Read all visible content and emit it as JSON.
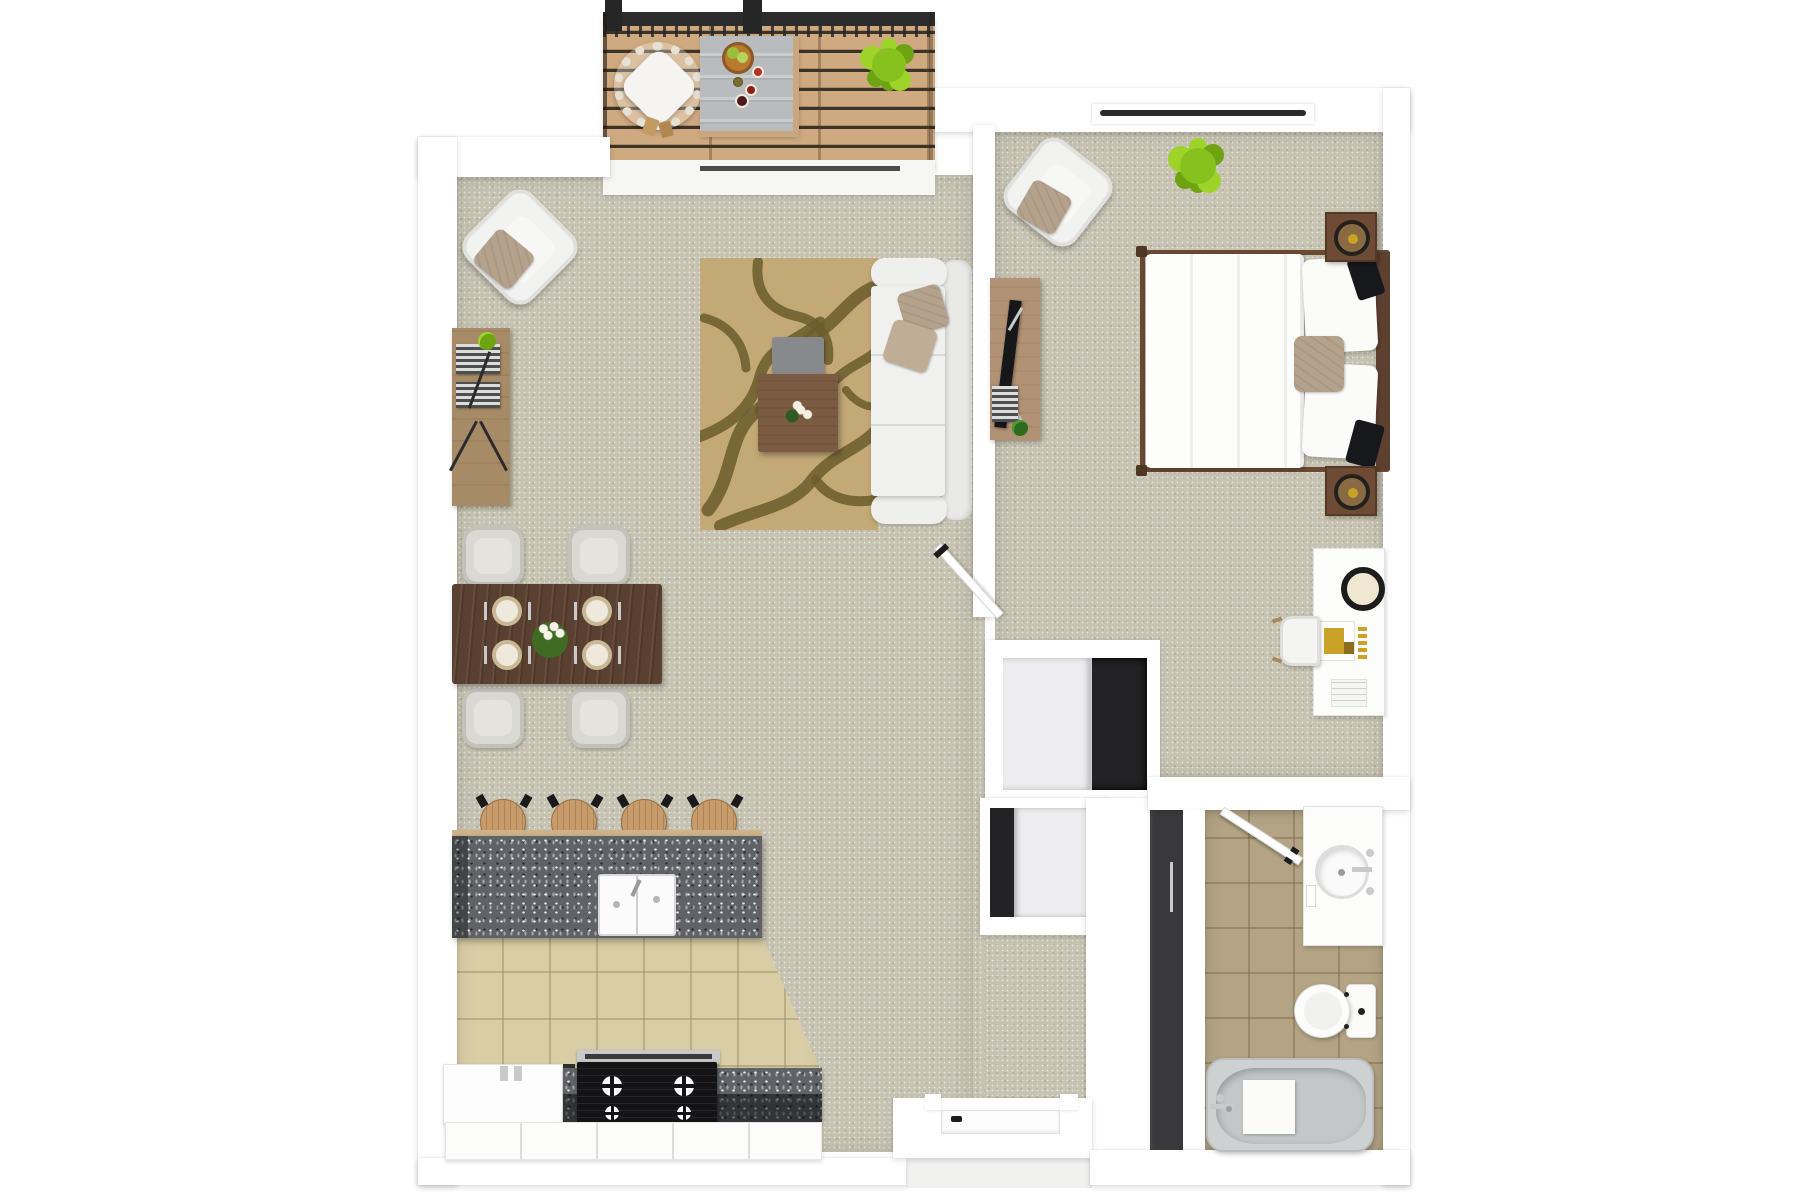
{
  "title": "one-bedroom-apartment-3d-floor-plan",
  "colors": {
    "wall": "#ffffff",
    "carpet": "#c7c3b2",
    "carpetDot": "#a8a593",
    "kitchenTile": "#d9cda6",
    "kitchenTileLine": "rgba(150,135,95,0.45)",
    "bathTile": "#b4a485",
    "bathTileLine": "rgba(120,103,72,0.45)",
    "granite": "#5f6267",
    "woodLight": "#a78b67",
    "walnut": "#5a4030",
    "deckWood": "#cfa97f",
    "deckGap": "#3a332a",
    "deckRail": "#2c2c2c",
    "sofaWhite": "#f0f0ee",
    "pillowTan": "#b5a28c",
    "rugBase": "#c3a975",
    "rugBranch": "#6d5d2f",
    "green": "#86c11e",
    "greenLight": "#9ed32a",
    "greenDark": "#6fa312",
    "gold": "#c9a227",
    "darkDoor": "#39393c",
    "closetDark": "#232326",
    "closetPanel": "#ededef",
    "steel": "#c9c9c9",
    "applianceBlack": "#141416",
    "tub": "#cdd1d2",
    "stoolWood": "#c79c6a",
    "concreteTable": "#b9bcbe",
    "bowlBrown": "#b97a2e",
    "lime": "#9abf3a",
    "cupRed": "#b33126",
    "cupDarkRed": "#8c1f1c",
    "cupBerry": "#4c1b20",
    "kiwi": "#7b6b2f",
    "headboard": "#5d402f",
    "bedFrame": "#6b4a33",
    "nightstand": "#6e4b35"
  },
  "rooms": [
    {
      "name": "balcony",
      "furniture": [
        "wood-deck",
        "railing",
        "hanging-chair",
        "outdoor-table",
        "fruit-bowl",
        "drink-cups",
        "potted-fern"
      ]
    },
    {
      "name": "living-room",
      "furniture": [
        "armchair",
        "console-bookshelf",
        "books",
        "area-rug",
        "sofa",
        "throw-pillows",
        "ottoman-tray",
        "coffee-table",
        "flower-vase",
        "sliding-balcony-door"
      ]
    },
    {
      "name": "dining-area",
      "furniture": [
        "dining-table",
        "dining-chair",
        "dining-chair",
        "dining-chair",
        "dining-chair",
        "place-setting",
        "place-setting",
        "place-setting",
        "place-setting",
        "flower-centerpiece"
      ]
    },
    {
      "name": "kitchen",
      "furniture": [
        "breakfast-bar",
        "bar-stool",
        "bar-stool",
        "bar-stool",
        "bar-stool",
        "double-sink",
        "refrigerator",
        "base-counter",
        "gas-stove",
        "range-hood",
        "base-cabinets"
      ]
    },
    {
      "name": "bedroom",
      "furniture": [
        "double-bed",
        "headboard",
        "pillows",
        "nightstand",
        "nightstand",
        "tv-console",
        "tv",
        "desk-chair",
        "potted-fern",
        "window-vent",
        "vanity-desk",
        "vanity-mirror",
        "vanity-stool",
        "bedroom-door"
      ]
    },
    {
      "name": "bathroom",
      "furniture": [
        "vanity-sink",
        "faucet",
        "toilet",
        "bathtub",
        "bath-mat",
        "bathroom-door",
        "pocket-door"
      ]
    },
    {
      "name": "closets",
      "furniture": [
        "walk-in-closet",
        "sliding-panel",
        "linen-closet"
      ]
    },
    {
      "name": "entry",
      "furniture": [
        "entry-door",
        "door-handle",
        "porch-step"
      ]
    }
  ],
  "counts": {
    "bar_stools": 4,
    "dining_chairs": 4,
    "place_settings": 4,
    "nightstands": 2,
    "closets": 2,
    "plants": 3
  }
}
